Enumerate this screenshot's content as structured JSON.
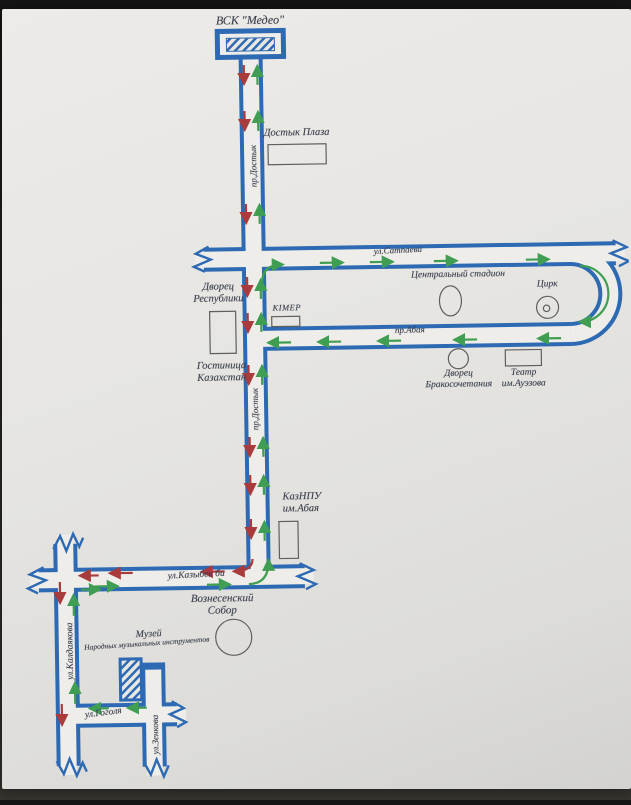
{
  "document_type": "photographed transit route map of Almaty streets",
  "colors": {
    "road_casing": "#2d6ab3",
    "road_fill": "#efede9",
    "paper": "#e6e5e1",
    "photo_background": "#1d1d1c",
    "route_forward_arrow": "#3f9e52",
    "route_return_arrow": "#a93b3c",
    "landmark_outline": "#5f5f5f",
    "label_text": "#3c4150"
  },
  "labels": {
    "medeo": "ВСК \"Медео\"",
    "dostyk_plaza": "Достык Плаза",
    "satpayeva": "ул.Сатпаева",
    "palace_republic": "Дворец\nРеспублики",
    "kimep": "КІМЕР",
    "stadium": "Центральный стадион",
    "circus": "Цирк",
    "abaya": "пр.Абая",
    "dostyk": "пр.Достык",
    "hotel": "Гостиница\nКазахстан",
    "wedding_palace": "Дворец\nБракосочетания",
    "theatre": "Театр\nим.Ауэзова",
    "kaznpu": "КазНПУ\nим.Абая",
    "kazybek_bi": "ул.Казыбек би",
    "cathedral": "Вознесенский\nСобор",
    "museum_title": "Музей",
    "museum_subtitle": "Народных музыкальных инструментов",
    "kaldayakova": "ул.Калдаякова",
    "gogolya": "ул.Гоголя",
    "zenkova": "ул.Зенкова"
  },
  "streets": [
    {
      "name": "пр.Достык",
      "orientation": "vertical"
    },
    {
      "name": "ул.Сатпаева",
      "orientation": "horizontal"
    },
    {
      "name": "пр.Абая",
      "orientation": "horizontal"
    },
    {
      "name": "ул.Казыбек би",
      "orientation": "horizontal"
    },
    {
      "name": "ул.Калдаякова",
      "orientation": "vertical"
    },
    {
      "name": "ул.Гоголя",
      "orientation": "horizontal"
    },
    {
      "name": "ул.Зенкова",
      "orientation": "vertical"
    }
  ],
  "landmarks": [
    {
      "name": "ВСК \"Медео\"",
      "shape": "hatched-rectangle"
    },
    {
      "name": "Достык Плаза",
      "shape": "rectangle"
    },
    {
      "name": "Дворец Республики",
      "shape": "rectangle"
    },
    {
      "name": "КІМЕР",
      "shape": "rectangle"
    },
    {
      "name": "Центральный стадион",
      "shape": "ellipse"
    },
    {
      "name": "Цирк",
      "shape": "circle-with-dot"
    },
    {
      "name": "Гостиница Казахстан",
      "shape": "ellipse"
    },
    {
      "name": "Дворец Бракосочетания",
      "shape": "circle"
    },
    {
      "name": "Театр им.Ауэзова",
      "shape": "rectangle"
    },
    {
      "name": "КазНПУ им.Абая",
      "shape": "rectangle"
    },
    {
      "name": "Вознесенский Собор",
      "shape": "circle"
    },
    {
      "name": "Музей Народных музыкальных инструментов",
      "shape": "hatched-rectangle"
    }
  ]
}
